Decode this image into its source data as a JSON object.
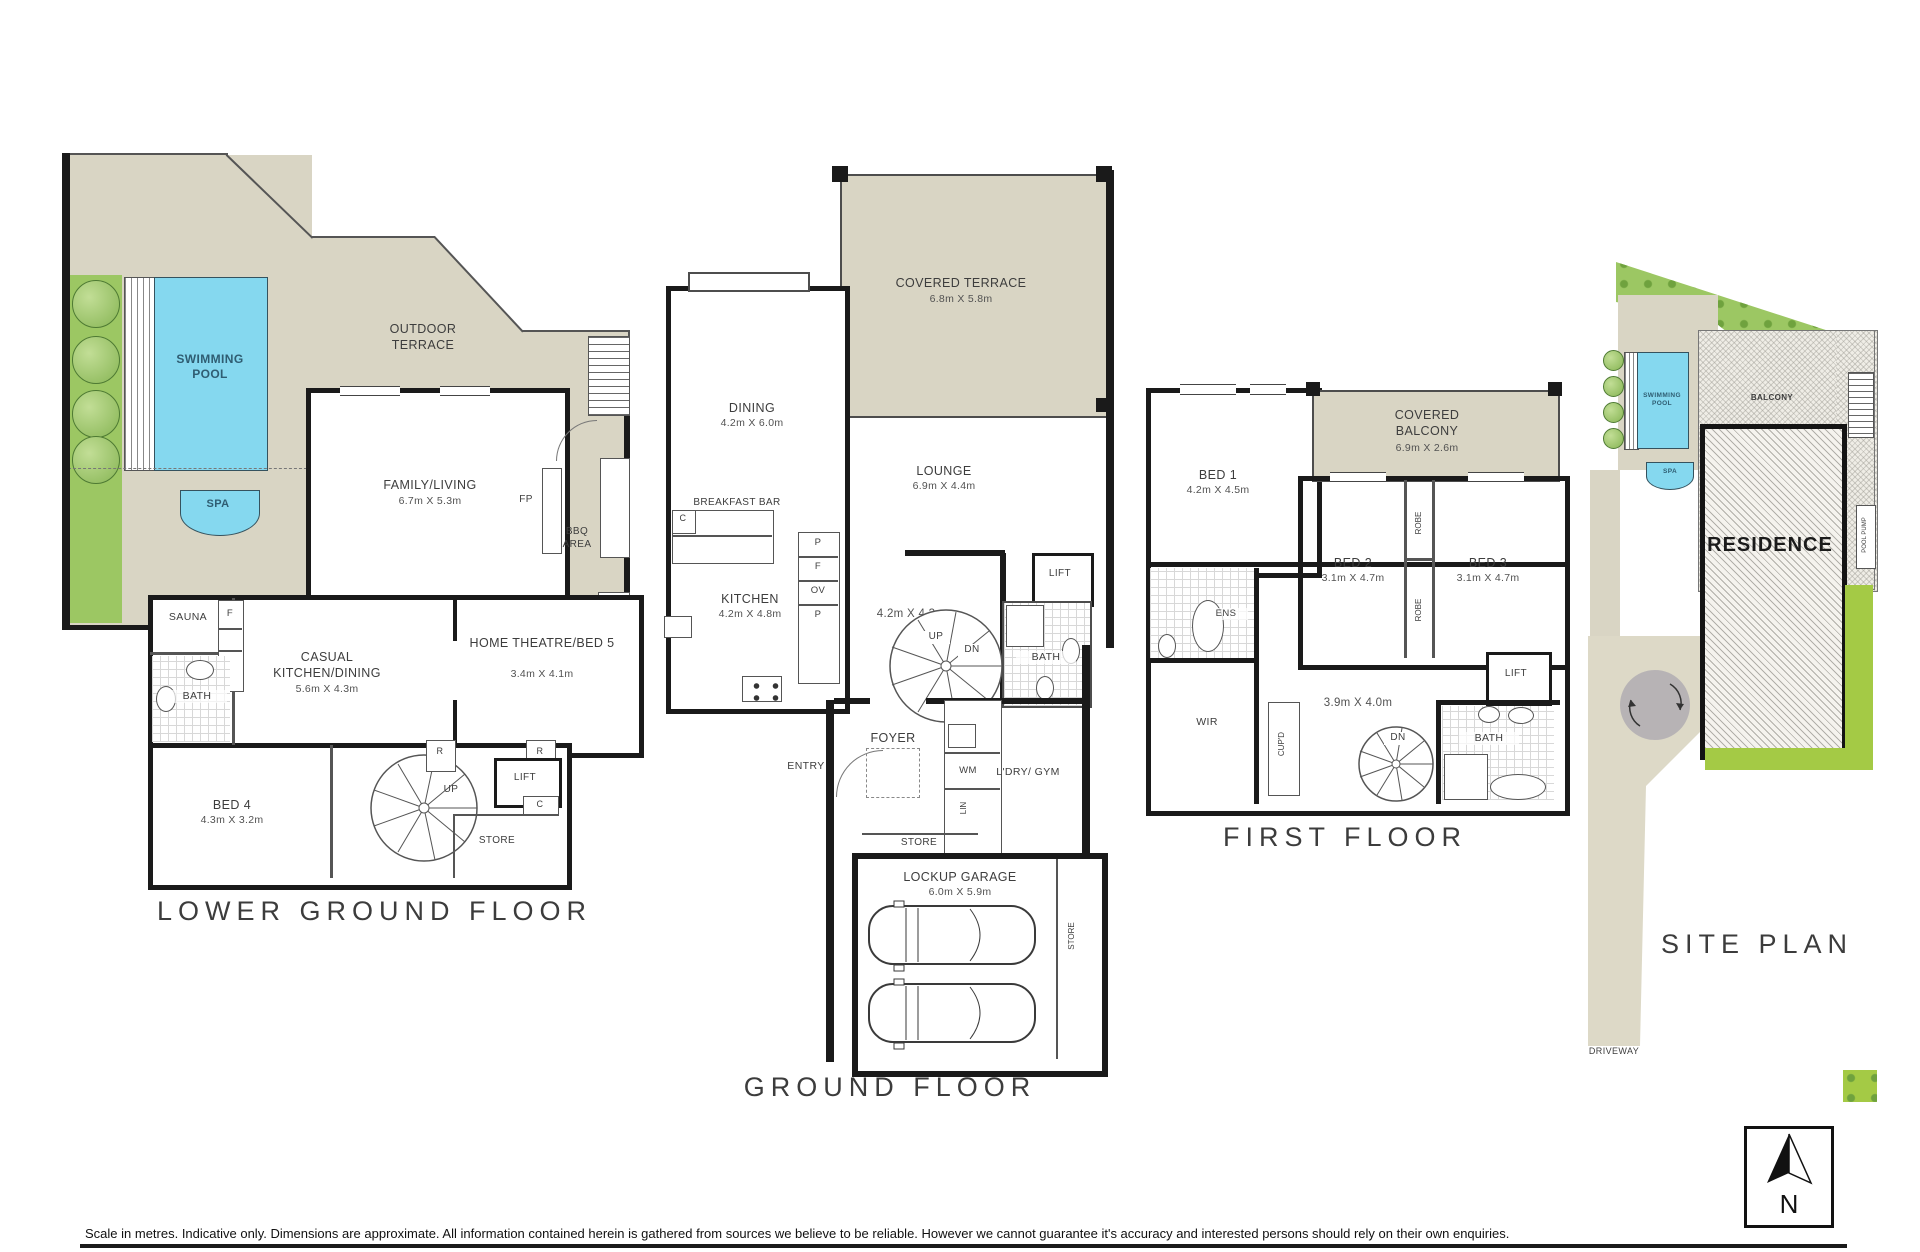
{
  "titles": {
    "lower": "LOWER GROUND FLOOR",
    "ground": "GROUND FLOOR",
    "first": "FIRST FLOOR",
    "site": "SITE PLAN"
  },
  "colors": {
    "terrace_beige": "#d9d5c4",
    "pool_cyan": "#85d8ef",
    "garden_green": "#9cc763",
    "site_green": "#a4ca45",
    "turnaround_grey": "#b7b3b5",
    "wall_black": "#1a1a1a",
    "label_grey": "#3d3d3d"
  },
  "lower": {
    "outdoor_terrace": "OUTDOOR TERRACE",
    "swimming_pool": "SWIMMING POOL",
    "spa": "SPA",
    "family": "FAMILY/LIVING",
    "family_dim": "6.7m X 5.3m",
    "sauna": "SAUNA",
    "f": "F",
    "bath": "BATH",
    "casual": "CASUAL KITCHEN/DINING",
    "casual_dim": "5.6m X 4.3m",
    "home_theatre": "HOME THEATRE/BED 5",
    "home_theatre_dim": "3.4m X 4.1m",
    "bed4": "BED 4",
    "bed4_dim": "4.3m X 3.2m",
    "up": "UP",
    "store": "STORE",
    "robe1": "R",
    "robe2": "R",
    "lift": "LIFT",
    "cupboard": "C",
    "fp": "FP",
    "bbq": "BBQ AREA",
    "pool_pump": "POOL PUMP"
  },
  "ground": {
    "covered_terrace": "COVERED TERRACE",
    "covered_terrace_dim": "6.8m X 5.8m",
    "dining": "DINING",
    "dining_dim": "4.2m X 6.0m",
    "lounge": "LOUNGE",
    "lounge_dim": "6.9m X 4.4m",
    "breakfast_bar": "BREAKFAST BAR",
    "counter_c": "C",
    "kitchen": "KITCHEN",
    "kitchen_dim": "4.2m X 4.8m",
    "p1": "P",
    "f": "F",
    "ov": "OV",
    "p2": "P",
    "hall_dim": "4.2m X 4.3m",
    "up": "UP",
    "dn": "DN",
    "lift": "LIFT",
    "bath": "BATH",
    "foyer": "FOYER",
    "entry": "ENTRY",
    "wm": "WM",
    "lin": "LIN",
    "laundry": "L'DRY/ GYM",
    "store": "STORE",
    "garage": "LOCKUP GARAGE",
    "garage_dim": "6.0m X 5.9m",
    "store_side": "STORE"
  },
  "first": {
    "bed1": "BED 1",
    "bed1_dim": "4.2m X 4.5m",
    "balcony": "COVERED BALCONY",
    "balcony_dim": "6.9m X 2.6m",
    "bed2": "BED 2",
    "bed2_dim": "3.1m X 4.7m",
    "bed3": "BED 3",
    "bed3_dim": "3.1m X 4.7m",
    "robe1": "ROBE",
    "robe2": "ROBE",
    "ens": "ENS",
    "wir": "WIR",
    "cupd": "CUP'D",
    "hall_dim": "3.9m X 4.0m",
    "dn": "DN",
    "lift": "LIFT",
    "bath": "BATH"
  },
  "site": {
    "pool": "SWIMMING POOL",
    "spa": "SPA",
    "balcony": "BALCONY",
    "residence": "RESIDENCE",
    "pool_pump": "POOL PUMP",
    "driveway": "DRIVEWAY"
  },
  "compass": {
    "letter": "N"
  },
  "footer": {
    "disclaimer": "Scale in metres. Indicative only. Dimensions are approximate. All information contained herein is gathered from sources we believe to be reliable. However we cannot guarantee it's accuracy and interested persons should rely on their own enquiries."
  }
}
